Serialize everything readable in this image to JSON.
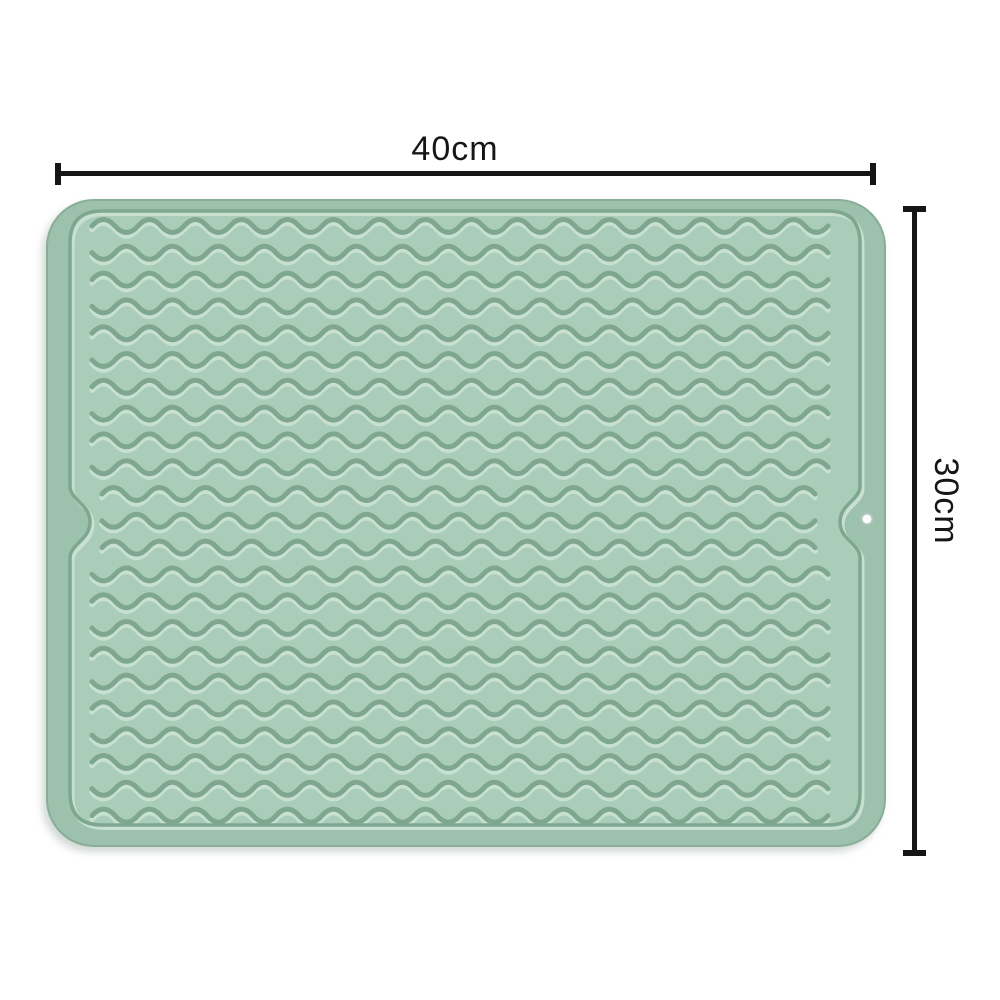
{
  "diagram": {
    "subject": "silicone-drying-mat",
    "dimensions": {
      "width": {
        "label": "40cm"
      },
      "height": {
        "label": "30cm"
      }
    }
  },
  "colors": {
    "background": "#ffffff",
    "mat_rim": "#9cc1ac",
    "mat_base": "#a9cdb8",
    "mat_outline": "#8aad97",
    "wave_shadow": "#7fa78f",
    "wave_highlight": "#c7e0d2",
    "hole_fill": "#fbfdfc",
    "hole_ring": "#b4c4ba",
    "dimension_line": "#161616"
  }
}
